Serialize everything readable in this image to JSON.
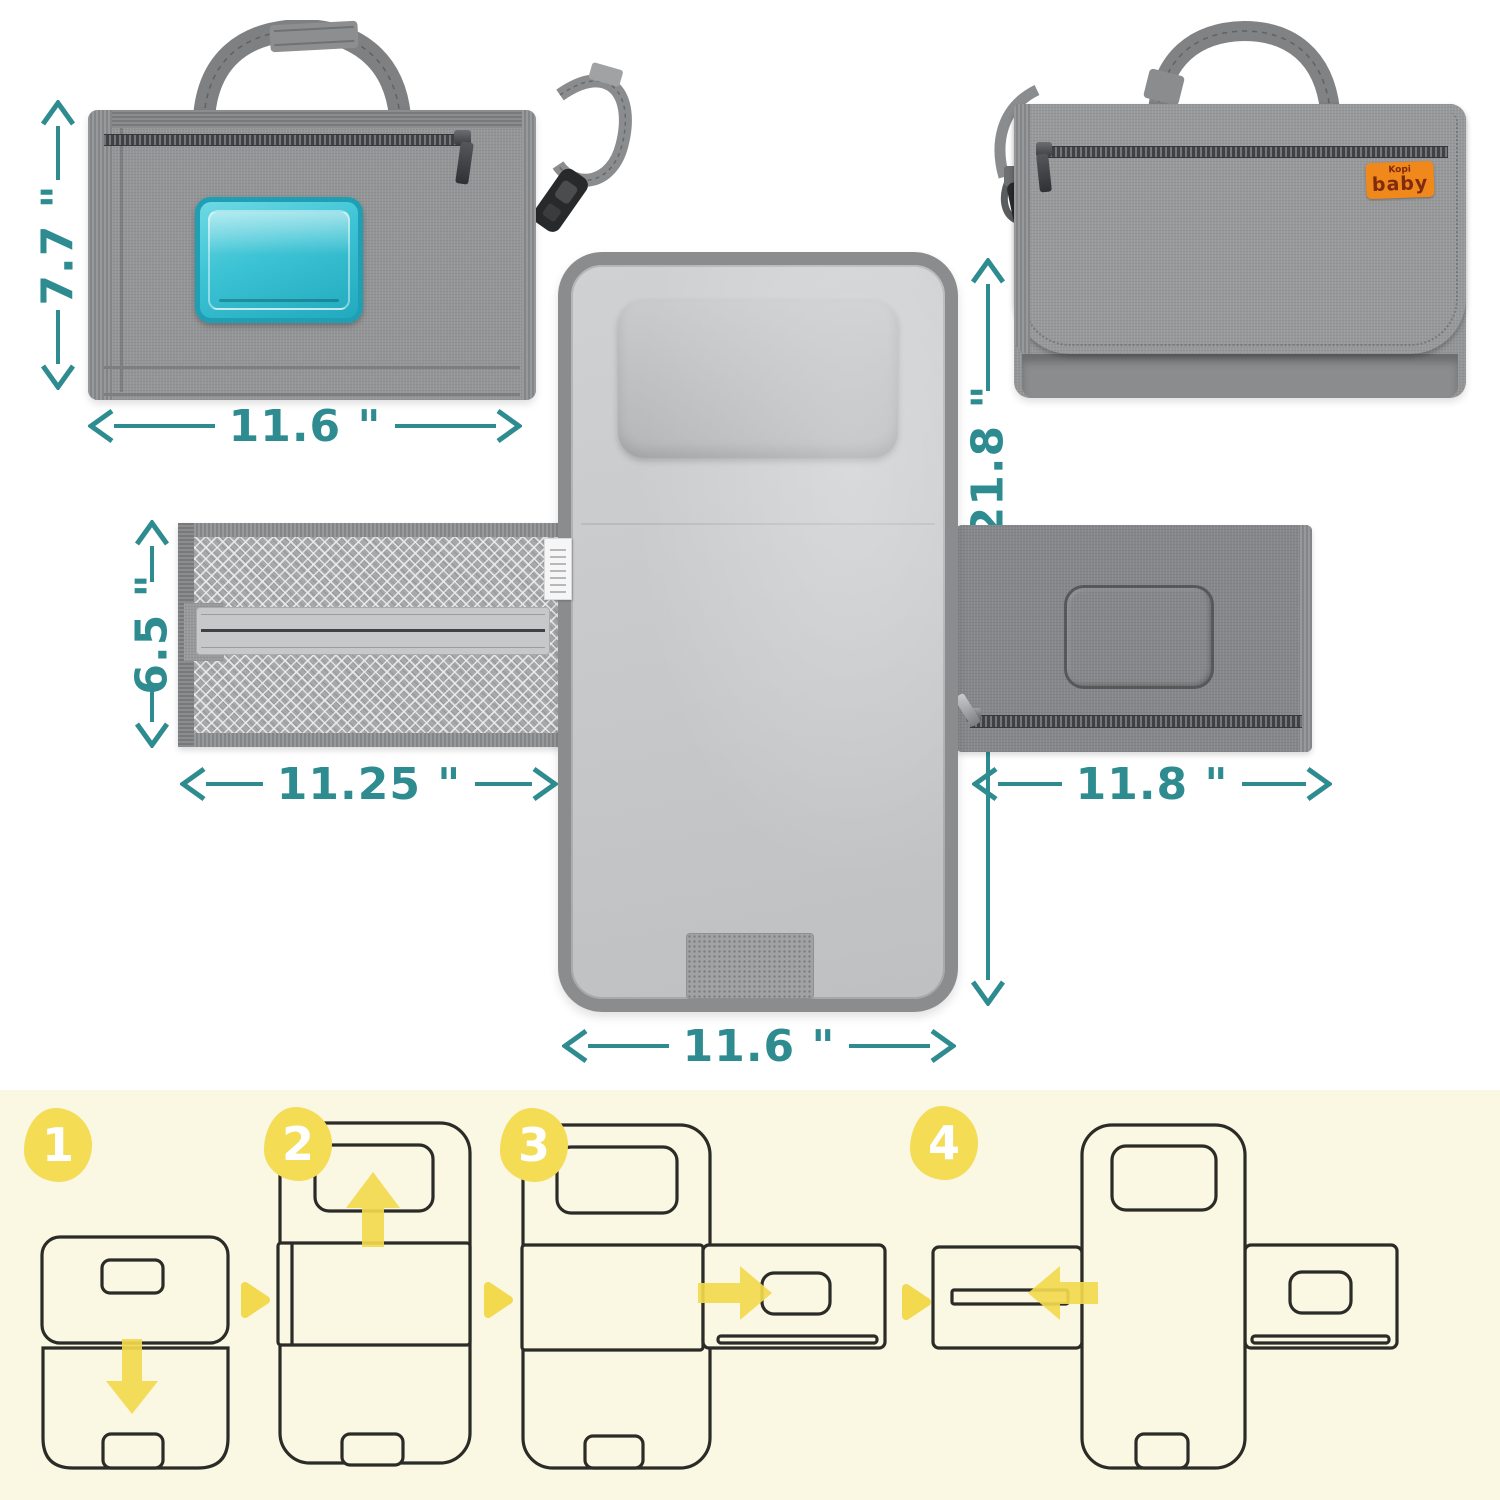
{
  "meta": {
    "title": "Portable diaper changing pad — dimensions and folding steps infographic"
  },
  "colors": {
    "dimension_teal": "#2E8C90",
    "step_yellow": "#F2D94E",
    "steps_background": "#FAF7E3",
    "brand_orange": "#F0881C",
    "brand_text": "#7E2B10",
    "wipes_teal": "#35BFD2",
    "fabric_gray": "#939597",
    "outline_dark": "#2B2B27"
  },
  "brand": {
    "name_top": "Kopi",
    "name_bottom": "baby"
  },
  "dimensions": {
    "folded_height": "7.7 \"",
    "folded_width": "11.6 \"",
    "unfolded_length": "21.8 \"",
    "mesh_pocket_height": "6.5 \"",
    "mesh_pocket_width": "11.25 \"",
    "wipes_pocket_width": "11.8 \"",
    "pad_width": "11.6 \""
  },
  "steps": [
    {
      "number": "1"
    },
    {
      "number": "2"
    },
    {
      "number": "3"
    },
    {
      "number": "4"
    }
  ]
}
